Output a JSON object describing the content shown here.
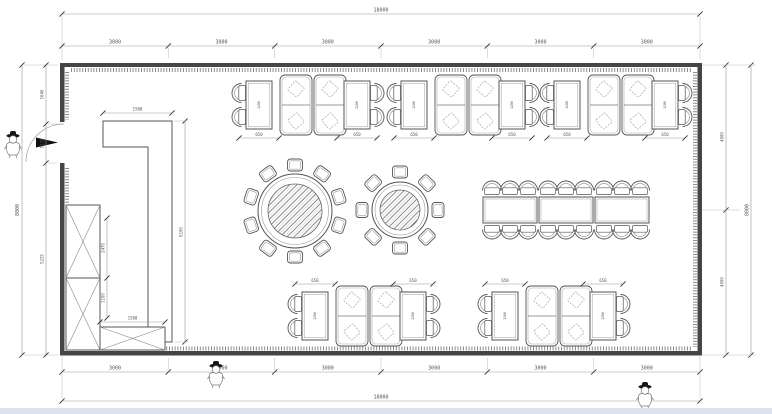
{
  "dimensions": {
    "overall_width": "18000",
    "overall_height": "8000",
    "top_segments": [
      "3000",
      "3000",
      "3000",
      "3000",
      "3000",
      "3000"
    ],
    "bottom_segments": [
      "3000",
      "3000",
      "3000",
      "3000",
      "3000",
      "3000"
    ],
    "left_segments": {
      "upper": "1640",
      "door": "1135",
      "lower": "5225"
    },
    "right_segments": {
      "upper": "4000",
      "lower": "4000"
    },
    "counter_length": "1500",
    "counter_run": "6100",
    "cabinet_upper": "2470",
    "cabinet_lower": "1100",
    "cabinet_width": "1500",
    "side_table_width": "650",
    "side_table_length": "1200"
  }
}
